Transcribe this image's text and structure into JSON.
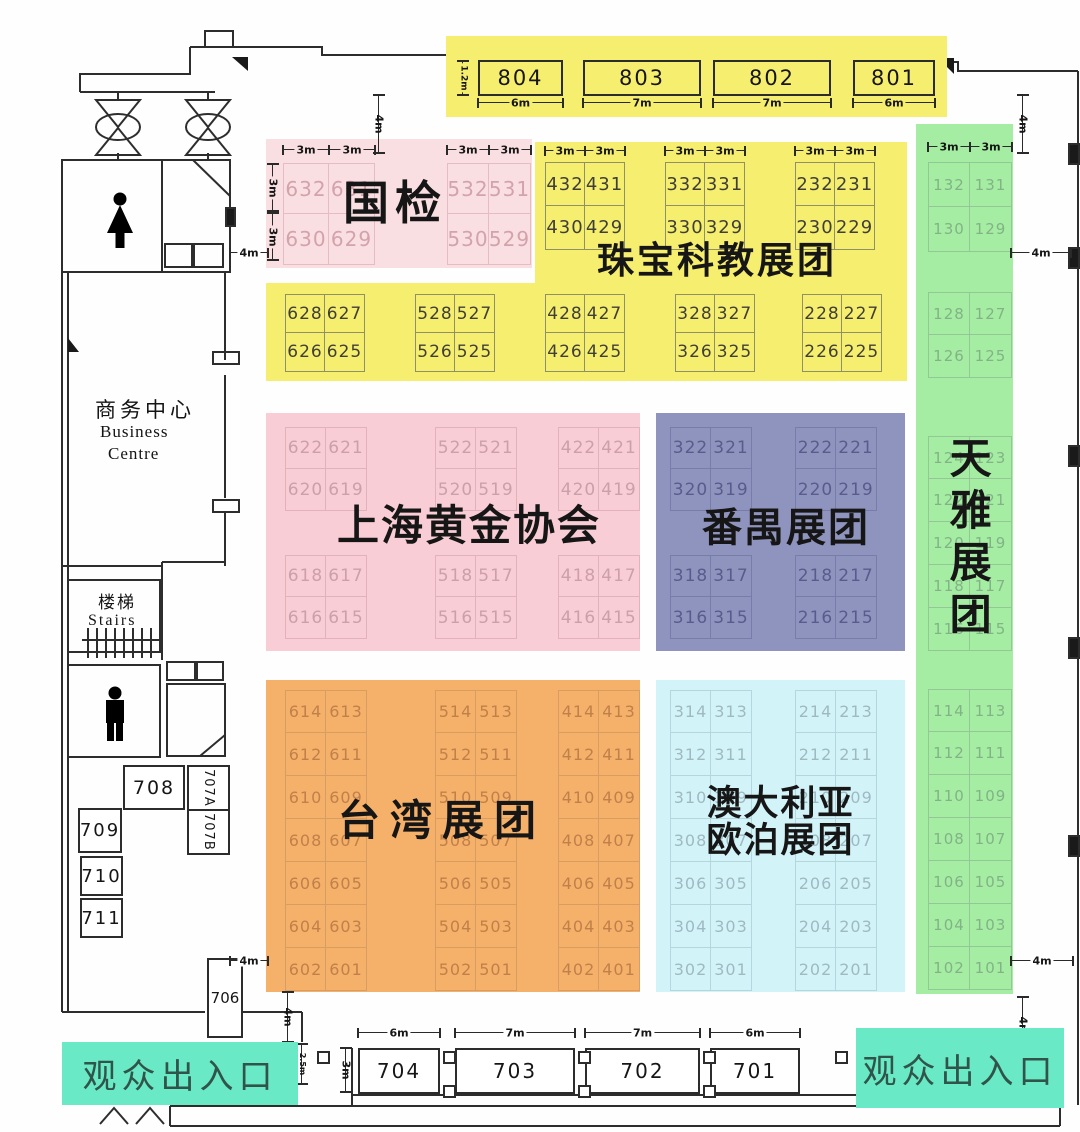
{
  "colors": {
    "yellow": "#f6ee6e",
    "pink_light": "#fadfe2",
    "pink": "#f9cdd5",
    "purple": "#8f94be",
    "orange": "#f5b06a",
    "blue": "#d2f4f9",
    "green": "#a5eda3",
    "teal": "#69e9c6"
  },
  "dims": {
    "m3": "3m",
    "m4": "4m",
    "m6": "6m",
    "m7": "7m",
    "m12": "1.2m",
    "m25": "2.5m"
  },
  "entrance_label": "观众出入口",
  "top_strip": {
    "booths": [
      {
        "id": "804",
        "w": "6m"
      },
      {
        "id": "803",
        "w": "7m"
      },
      {
        "id": "802",
        "w": "7m"
      },
      {
        "id": "801",
        "w": "6m"
      }
    ],
    "height_label": "1.2m"
  },
  "bottom_strip": {
    "booths": [
      {
        "id": "704",
        "w": "6m"
      },
      {
        "id": "703",
        "w": "7m"
      },
      {
        "id": "702",
        "w": "7m"
      },
      {
        "id": "701",
        "w": "6m"
      }
    ],
    "height_label": "3m",
    "side_label": "2.5m"
  },
  "left": {
    "business_centre": {
      "cn": "商务中心",
      "en1": "Business",
      "en2": "Centre"
    },
    "stairs": {
      "cn": "楼梯",
      "en": "Stairs"
    },
    "booths": {
      "b708": "708",
      "b709": "709",
      "b710": "710",
      "b711": "711",
      "b707a": "707A",
      "b707b": "707B",
      "b706": "706"
    }
  },
  "zones": {
    "guojian": {
      "title": "国检",
      "left": [
        [
          "632",
          "631"
        ],
        [
          "630",
          "629"
        ]
      ],
      "right": [
        [
          "532",
          "531"
        ],
        [
          "530",
          "529"
        ]
      ]
    },
    "zhubao": {
      "title": "珠宝科教展团",
      "top": {
        "gA": [
          [
            "432",
            "431"
          ],
          [
            "430",
            "429"
          ]
        ],
        "gB": [
          [
            "332",
            "331"
          ],
          [
            "330",
            "329"
          ]
        ],
        "gC": [
          [
            "232",
            "231"
          ],
          [
            "230",
            "229"
          ]
        ]
      },
      "bottom": {
        "gA": [
          [
            "628",
            "627"
          ],
          [
            "626",
            "625"
          ]
        ],
        "gB": [
          [
            "528",
            "527"
          ],
          [
            "526",
            "525"
          ]
        ],
        "gC": [
          [
            "428",
            "427"
          ],
          [
            "426",
            "425"
          ]
        ],
        "gD": [
          [
            "328",
            "327"
          ],
          [
            "326",
            "325"
          ]
        ],
        "gE": [
          [
            "228",
            "227"
          ],
          [
            "226",
            "225"
          ]
        ]
      }
    },
    "shgold": {
      "title": "上海黄金协会",
      "upper": {
        "gA": [
          [
            "622",
            "621"
          ],
          [
            "620",
            "619"
          ]
        ],
        "gB": [
          [
            "522",
            "521"
          ],
          [
            "520",
            "519"
          ]
        ],
        "gC": [
          [
            "422",
            "421"
          ],
          [
            "420",
            "419"
          ]
        ]
      },
      "lower": {
        "gA": [
          [
            "618",
            "617"
          ],
          [
            "616",
            "615"
          ]
        ],
        "gB": [
          [
            "518",
            "517"
          ],
          [
            "516",
            "515"
          ]
        ],
        "gC": [
          [
            "418",
            "417"
          ],
          [
            "416",
            "415"
          ]
        ]
      }
    },
    "panyu": {
      "title": "番禺展团",
      "upper": {
        "gA": [
          [
            "322",
            "321"
          ],
          [
            "320",
            "319"
          ]
        ],
        "gB": [
          [
            "222",
            "221"
          ],
          [
            "220",
            "219"
          ]
        ]
      },
      "lower": {
        "gA": [
          [
            "318",
            "317"
          ],
          [
            "316",
            "315"
          ]
        ],
        "gB": [
          [
            "218",
            "217"
          ],
          [
            "216",
            "215"
          ]
        ]
      }
    },
    "taiwan": {
      "title": "台湾展团",
      "colA": [
        [
          "614",
          "613"
        ],
        [
          "612",
          "611"
        ],
        [
          "610",
          "609"
        ],
        [
          "608",
          "607"
        ],
        [
          "606",
          "605"
        ],
        [
          "604",
          "603"
        ],
        [
          "602",
          "601"
        ]
      ],
      "colB": [
        [
          "514",
          "513"
        ],
        [
          "512",
          "511"
        ],
        [
          "510",
          "509"
        ],
        [
          "508",
          "507"
        ],
        [
          "506",
          "505"
        ],
        [
          "504",
          "503"
        ],
        [
          "502",
          "501"
        ]
      ],
      "colC": [
        [
          "414",
          "413"
        ],
        [
          "412",
          "411"
        ],
        [
          "410",
          "409"
        ],
        [
          "408",
          "407"
        ],
        [
          "406",
          "405"
        ],
        [
          "404",
          "403"
        ],
        [
          "402",
          "401"
        ]
      ]
    },
    "opal": {
      "title1": "澳大利亚",
      "title2": "欧泊展团",
      "colA": [
        [
          "314",
          "313"
        ],
        [
          "312",
          "311"
        ],
        [
          "310",
          "309"
        ],
        [
          "308",
          "307"
        ],
        [
          "306",
          "305"
        ],
        [
          "304",
          "303"
        ],
        [
          "302",
          "301"
        ]
      ],
      "colB": [
        [
          "214",
          "213"
        ],
        [
          "212",
          "211"
        ],
        [
          "210",
          "209"
        ],
        [
          "208",
          "207"
        ],
        [
          "206",
          "205"
        ],
        [
          "204",
          "203"
        ],
        [
          "202",
          "201"
        ]
      ]
    },
    "tianya": {
      "title": "天雅展团",
      "groupA": [
        [
          "132",
          "131"
        ],
        [
          "130",
          "129"
        ]
      ],
      "groupB": [
        [
          "128",
          "127"
        ],
        [
          "126",
          "125"
        ]
      ],
      "groupC": [
        [
          "124",
          "123"
        ],
        [
          "122",
          "121"
        ],
        [
          "120",
          "119"
        ],
        [
          "118",
          "117"
        ],
        [
          "116",
          "115"
        ]
      ],
      "groupD": [
        [
          "114",
          "113"
        ],
        [
          "112",
          "111"
        ],
        [
          "110",
          "109"
        ],
        [
          "108",
          "107"
        ],
        [
          "106",
          "105"
        ],
        [
          "104",
          "103"
        ],
        [
          "102",
          "101"
        ]
      ]
    }
  }
}
